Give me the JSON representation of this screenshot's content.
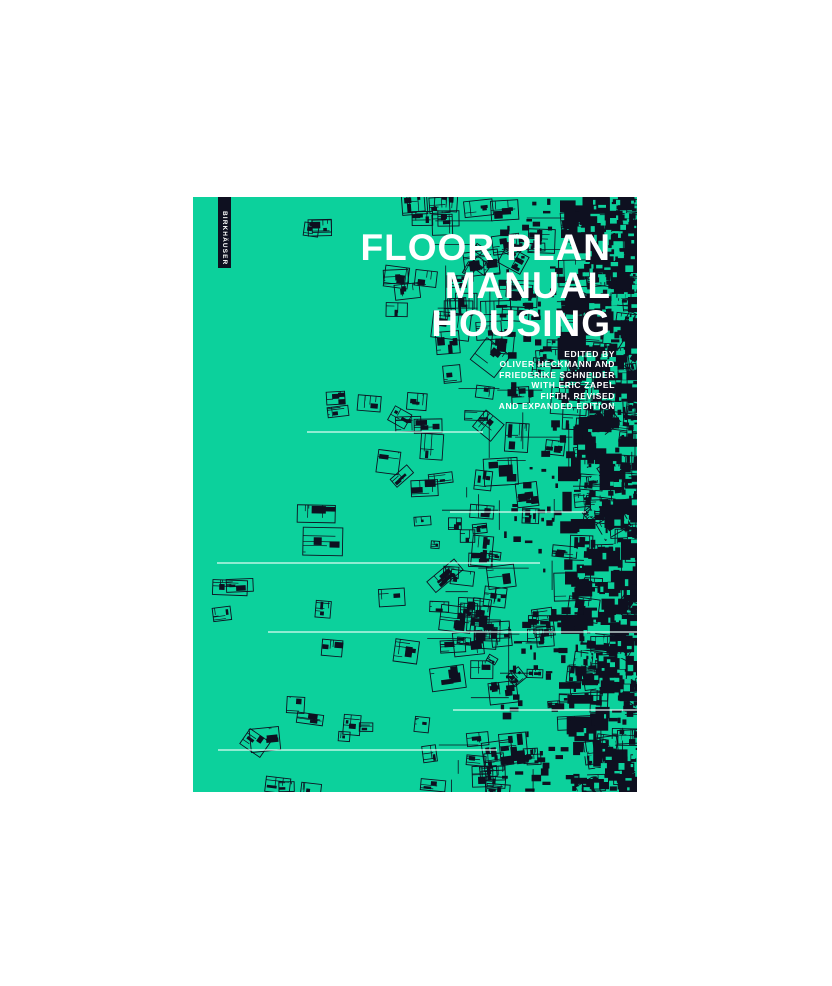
{
  "cover": {
    "title_lines": [
      "FLOOR PLAN",
      "MANUAL",
      "HOUSING"
    ],
    "credits_lines": [
      "EDITED BY",
      "OLIVER HECKMANN AND",
      "FRIEDERIKE SCHNEIDER",
      "WITH ERIC ZAPEL",
      "FIFTH, REVISED",
      "AND EXPANDED EDITION"
    ],
    "spine_text": "BIRKHÄUSER",
    "colors": {
      "background": "#0cd19c",
      "ink": "#0e1020",
      "text": "#ffffff",
      "hairline": "#eafff8",
      "page": "#ffffff"
    }
  }
}
